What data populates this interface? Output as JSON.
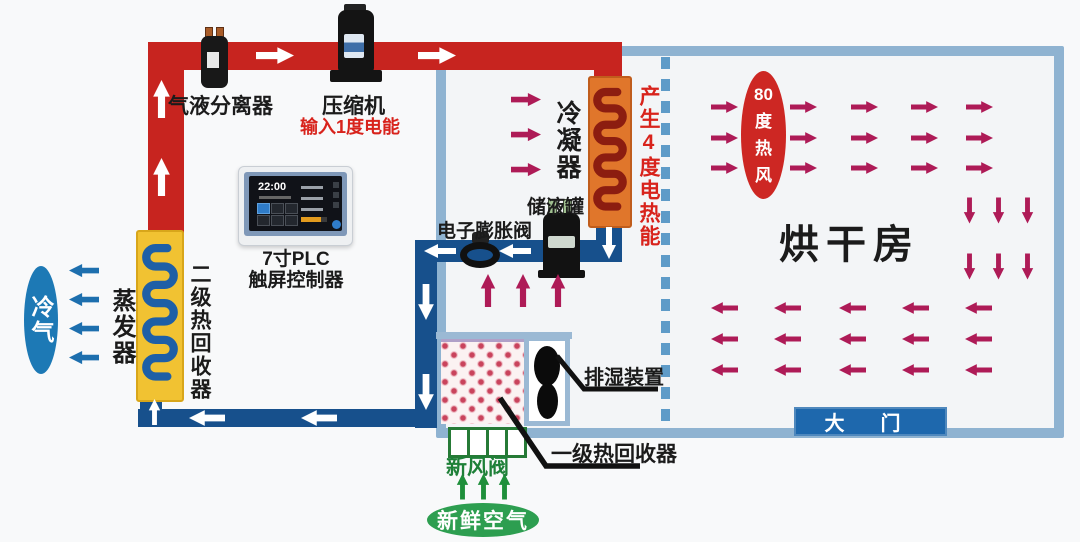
{
  "components": {
    "separator": {
      "label": "气液分离器"
    },
    "compressor": {
      "label": "压缩机",
      "note": "输入1度电能"
    },
    "plc": {
      "label_line1": "7寸PLC",
      "label_line2": "触屏控制器",
      "screen_time": "22:00"
    },
    "condenser": {
      "label": "冷凝器",
      "note": "产生4度电热能"
    },
    "receiver": {
      "label": "储液罐"
    },
    "expansion_valve": {
      "label": "电子膨胀阀"
    },
    "evaporator": {
      "label": "蒸发器"
    },
    "heat_recovery_2": {
      "label": "二级热回收器"
    },
    "heat_recovery_1": {
      "label": "一级热回收器"
    },
    "dehumidifier": {
      "label": "排湿装置"
    },
    "fresh_air_valve": {
      "label": "新风阀"
    }
  },
  "room": {
    "label": "烘干房",
    "door_label": "大门"
  },
  "flows": {
    "cold_air_label": "冷气",
    "hot_air_lines": [
      "80",
      "度",
      "热",
      "风"
    ],
    "fresh_air_label": "新鲜空气"
  },
  "colors": {
    "hot_pipe": "#c7241f",
    "cold_pipe": "#17508c",
    "wall": "#8fb3d1",
    "partition_dash": "#5e9bc8",
    "hot_airflow_arrow": "#ae1b57",
    "cold_airflow_arrow": "#1d6fae",
    "fresh_airflow_arrow": "#1f8f3b",
    "pipe_flow_arrow": "#ffffff",
    "condenser_coil": "#e0762b",
    "condenser_tube": "#8c1d10",
    "evaporator_coil": "#f1c232",
    "evaporator_tube": "#1e5fa6",
    "cold_air_badge": "#1d79b5",
    "hot_air_badge": "#cd2723",
    "fresh_air_badge": "#2d9e50",
    "door_badge": "#1e68ad"
  }
}
